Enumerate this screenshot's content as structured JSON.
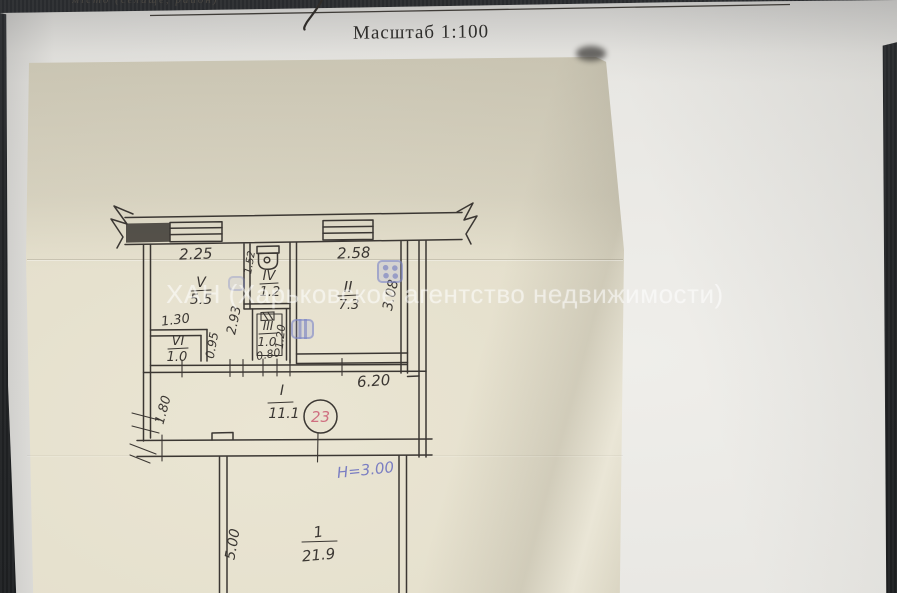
{
  "document": {
    "top_caption": "місто (селище, район)",
    "scale_label": "Масштаб 1:100"
  },
  "watermark": {
    "text": "ХАН (Харьковское агентство недвижимости)"
  },
  "plan": {
    "rooms": [
      {
        "numeral": "V",
        "area": "5.5"
      },
      {
        "numeral": "IV",
        "area": "1.2"
      },
      {
        "numeral": "III",
        "area": "1.0"
      },
      {
        "numeral": "VI",
        "area": "1.0"
      },
      {
        "numeral": "II",
        "area": "7.3"
      },
      {
        "numeral": "I",
        "area": "11.1"
      },
      {
        "numeral": "1",
        "area": "21.9"
      }
    ],
    "dims": {
      "top_left": "2.25",
      "top_right": "2.58",
      "vi_top": "1.30",
      "iv_side": "1.52",
      "v_side": "2.93",
      "vi_side": "0.95",
      "iii_bottom": "0.80",
      "iii_side": "1.20",
      "ii_side": "3.08",
      "hall_width": "6.20",
      "hall_side": "1.80",
      "room1_side": "5.00"
    },
    "apartment_number": "23",
    "height_note": "Н=3.00"
  },
  "colors": {
    "background": "#26282b",
    "white_sheet": "#e9e8e4",
    "plan_sheet": "#e5e0cd",
    "ink": "#3b3733",
    "red_note": "#cf6f80",
    "blue_note": "#7a7ec2",
    "stamp_blue": "#8a94c8",
    "watermark_white": "rgba(255,255,255,0.52)"
  }
}
